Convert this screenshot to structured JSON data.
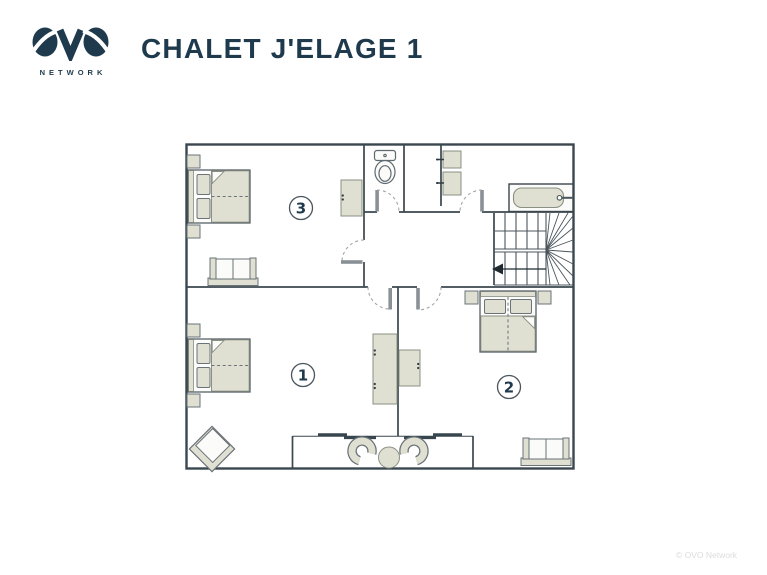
{
  "header": {
    "logo": {
      "brand": "OVO",
      "subtitle": "NETWORK"
    },
    "title": "CHALET J'ELAGE 1"
  },
  "plan": {
    "rooms": [
      {
        "id": "bedroom-1",
        "number": "1"
      },
      {
        "id": "bedroom-2",
        "number": "2"
      },
      {
        "id": "bedroom-3",
        "number": "3"
      }
    ],
    "icons": [
      "double-bed",
      "nightstand",
      "sofa",
      "wardrobe",
      "toilet",
      "bathtub",
      "staircase",
      "stair-direction-arrow",
      "armchair",
      "balcony-chair",
      "round-table",
      "door-swing",
      "sliding-door"
    ]
  },
  "footer": {
    "watermark": "© OVO Network"
  },
  "colors": {
    "brand_navy": "#1e3a4c",
    "wall_dark": "#3a474f",
    "furniture_beige": "#dfdfd2",
    "furniture_outline": "#8a9084",
    "door_leaf_gray": "#8a9196",
    "watermark_gray": "#dcdcdc"
  }
}
